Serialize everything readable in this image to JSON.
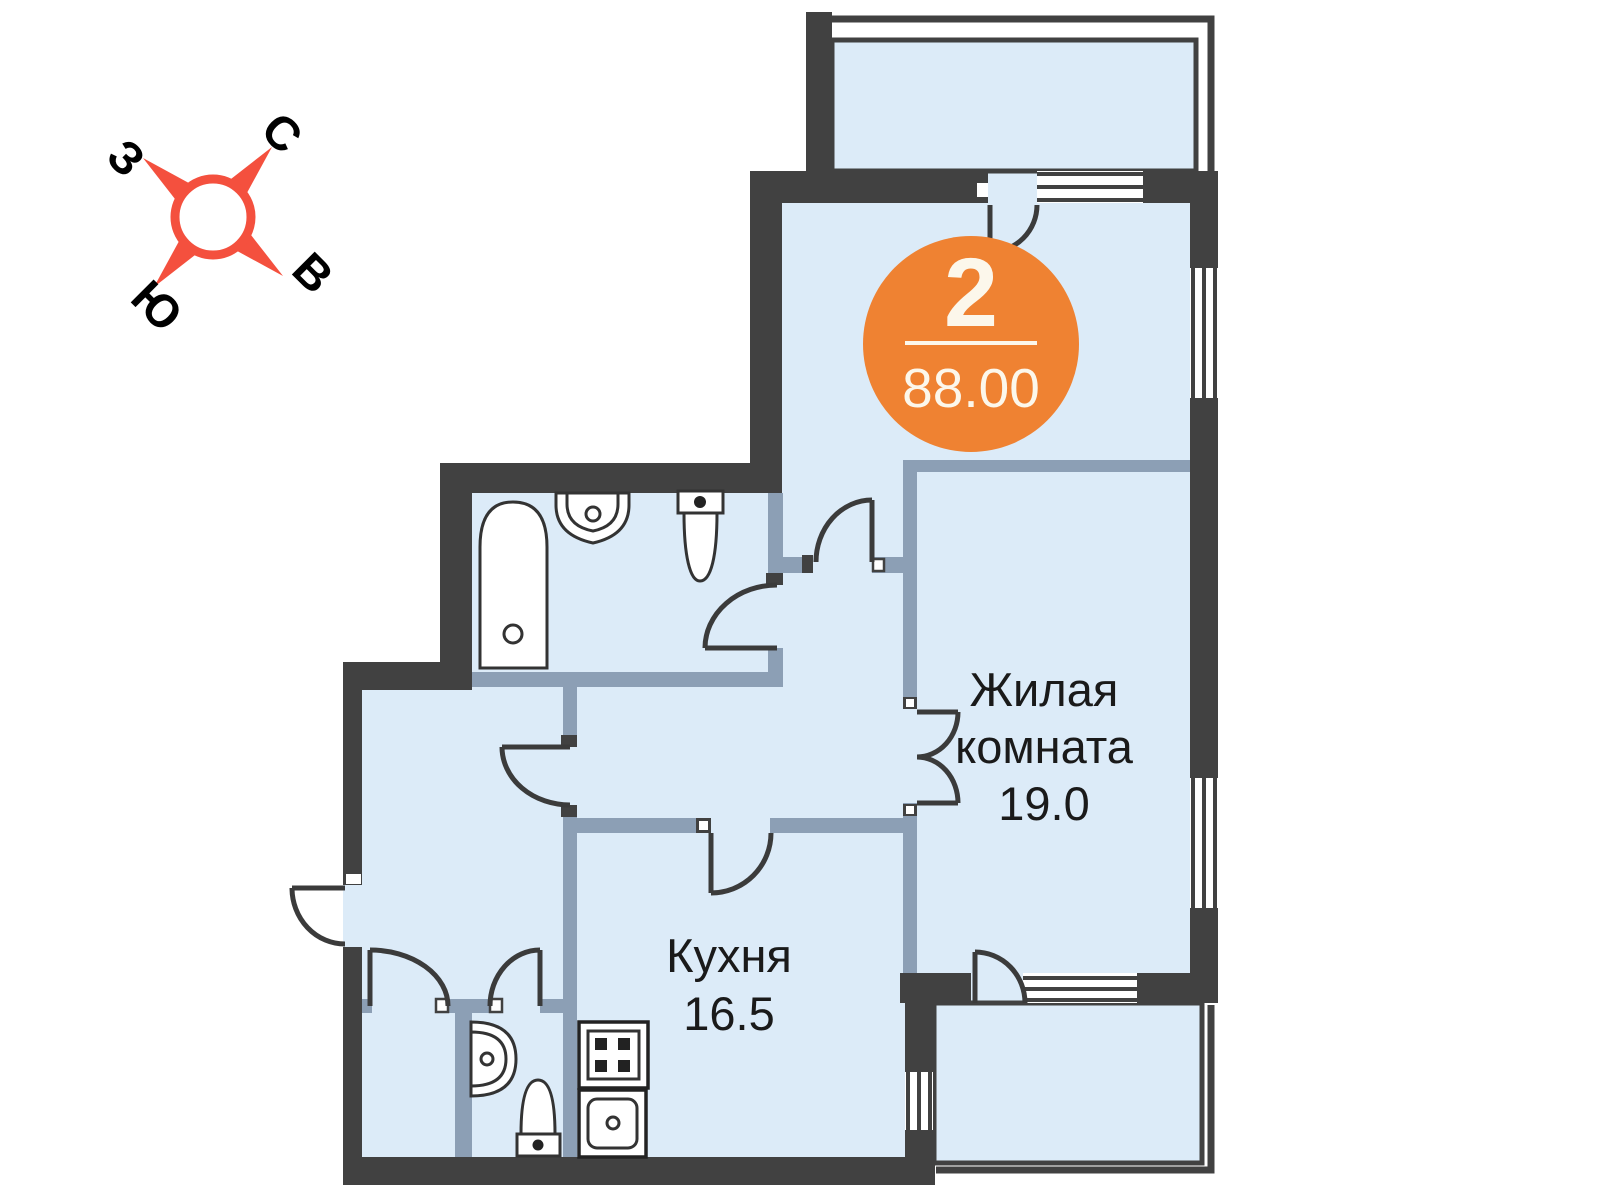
{
  "compass": {
    "north": "С",
    "east": "В",
    "south": "Ю",
    "west": "З",
    "star_color": "#F4503E",
    "label_color": "#000000"
  },
  "badge": {
    "rooms_count": "2",
    "total_area": "88.00",
    "bg_color": "#EF8232",
    "text_color": "#FCF7EB"
  },
  "rooms": {
    "living_room": {
      "label_line1": "Жилая",
      "label_line2": "комната",
      "area": "19.0"
    },
    "kitchen": {
      "label": "Кухня",
      "area": "16.5"
    }
  },
  "plan_colors": {
    "exterior_wall": "#414141",
    "interior_wall": "#8C9FB5",
    "floor": "#DCEBF8",
    "door_stroke": "#3B3B3B",
    "label_color": "#1A1A1A"
  }
}
